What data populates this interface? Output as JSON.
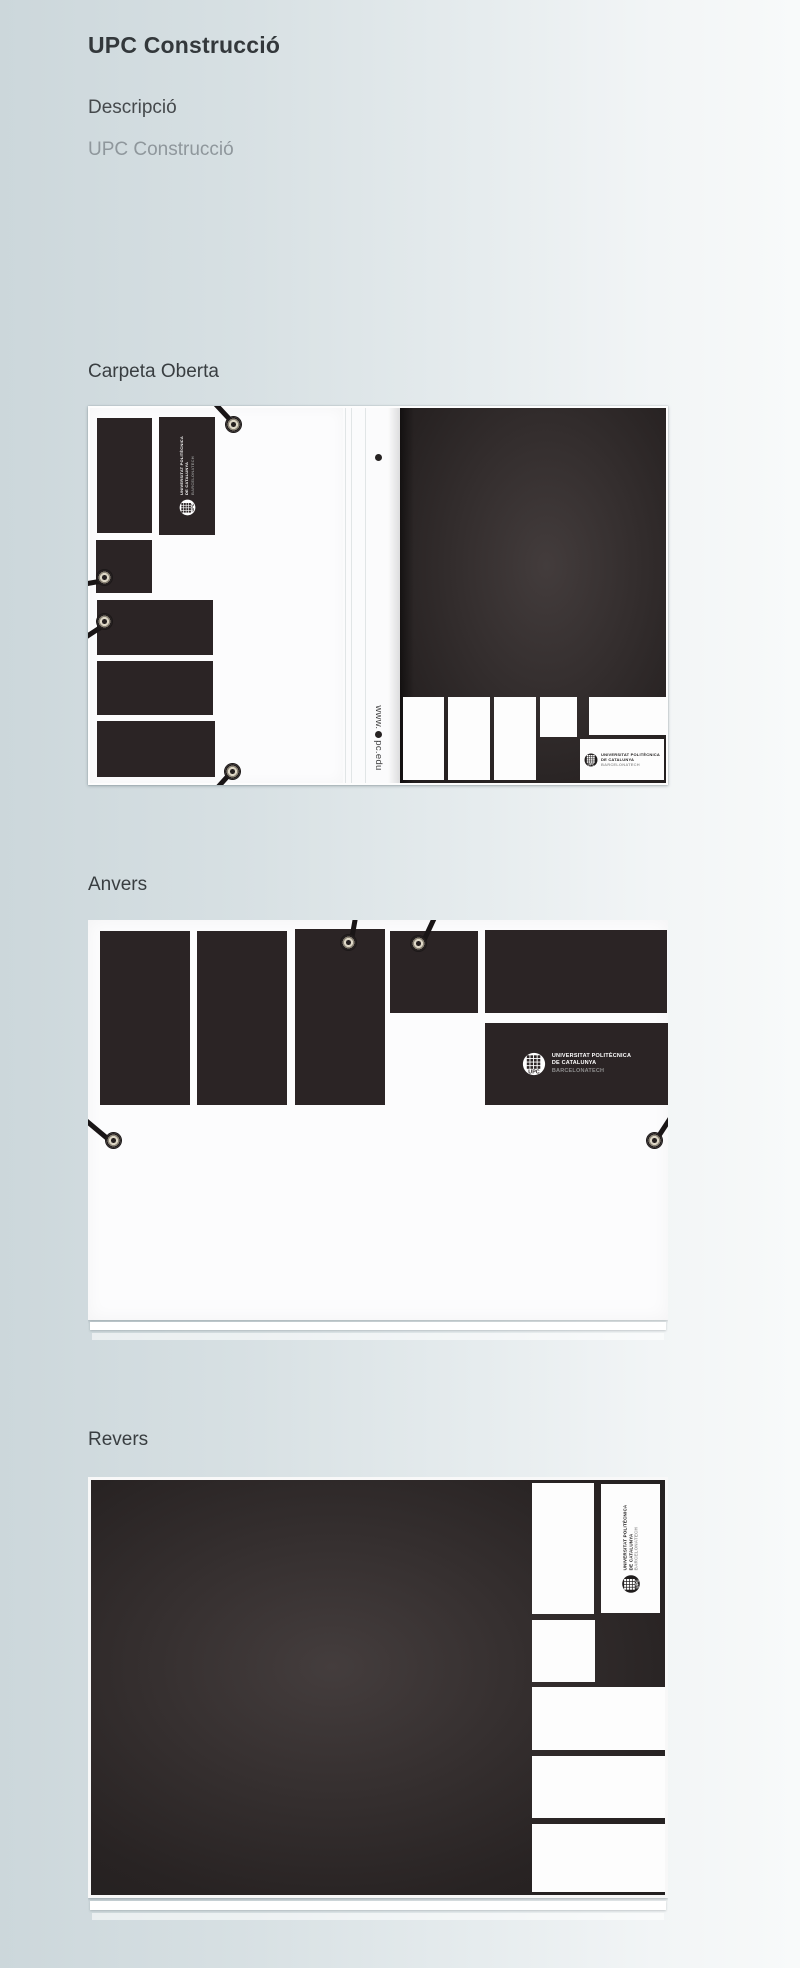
{
  "page": {
    "title": "UPC Construcció",
    "subtitle": "Descripció",
    "description": "UPC Construcció"
  },
  "sections": {
    "carpeta": {
      "heading": "Carpeta Oberta"
    },
    "anvers": {
      "heading": "Anvers"
    },
    "revers": {
      "heading": "Revers"
    }
  },
  "brand": {
    "name_line1": "UNIVERSITAT POLITÈCNICA",
    "name_line2": "DE CATALUNYA",
    "tagline": "BARCELONATECH",
    "acronym": "UPC"
  },
  "folder": {
    "spine_before": "www.",
    "spine_after": "pc.edu"
  },
  "colors": {
    "background_left": "#ccd7db",
    "background_right": "#f8fafa",
    "ink": "#2b2425",
    "paper": "#fcfcfd",
    "muted_text": "#8f979c",
    "tagline_gray": "#9b9b9b"
  }
}
